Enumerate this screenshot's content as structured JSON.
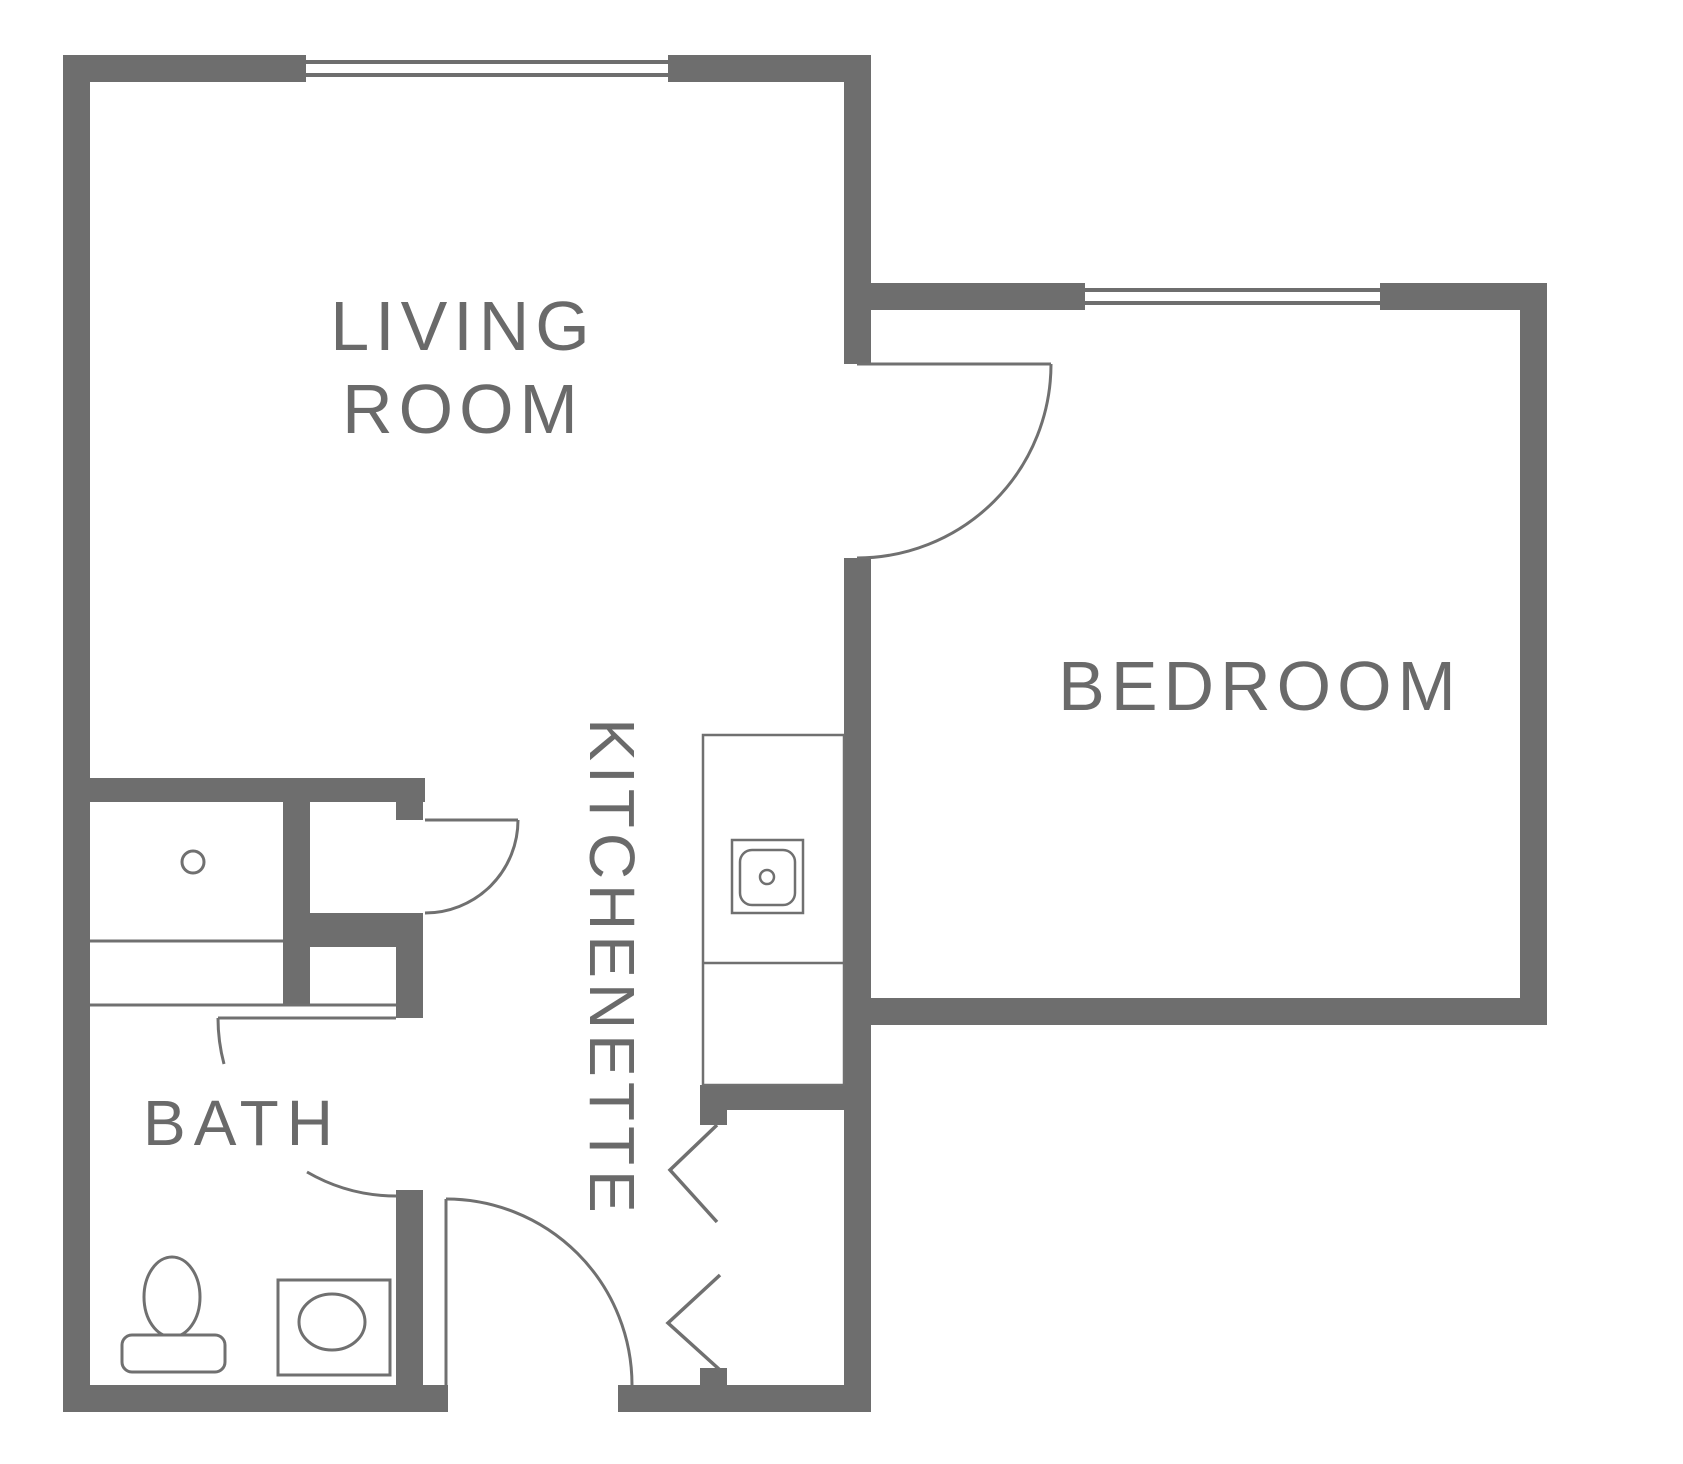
{
  "colors": {
    "wall": "#6e6e6e",
    "line": "#707070",
    "label": "#6a6a6a",
    "background": "#ffffff"
  },
  "rooms": {
    "living_room": {
      "line1": "LIVING",
      "line2": "ROOM"
    },
    "bedroom": {
      "label": "BEDROOM"
    },
    "kitchenette": {
      "label": "KITCHENETTE"
    },
    "bath": {
      "label": "BATH"
    }
  }
}
